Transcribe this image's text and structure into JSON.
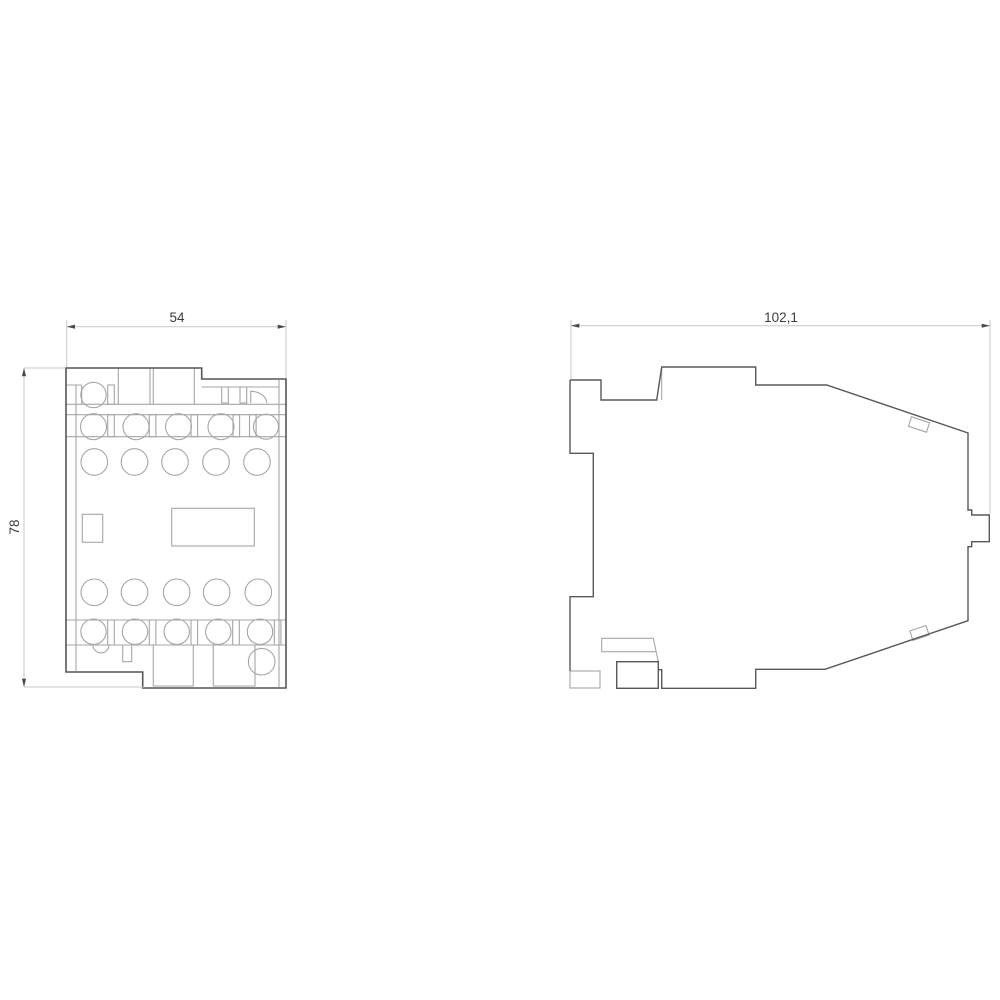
{
  "diagram": {
    "kind": "technical-dimension-drawing",
    "views": {
      "front": {
        "width_label": "54",
        "height_label": "78"
      },
      "side": {
        "width_label": "102,1"
      }
    },
    "colors": {
      "outline": "#555555",
      "detail_line": "#a6a6a6",
      "dimension_line": "#c9c9c9",
      "arrowhead": "#4a4a4a",
      "label_text": "#3c3c3c",
      "background": "#ffffff"
    }
  }
}
